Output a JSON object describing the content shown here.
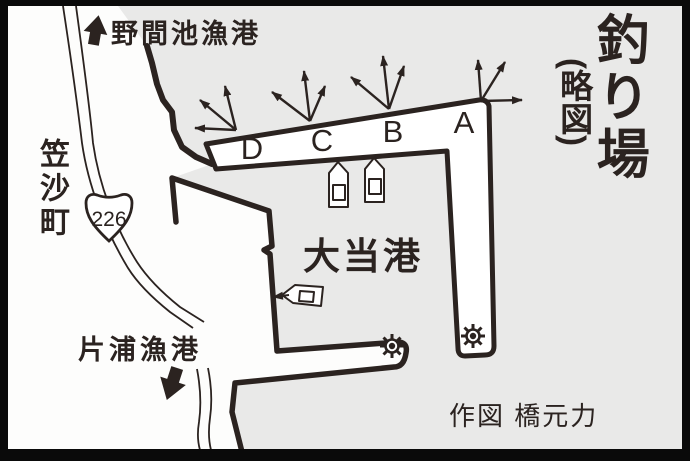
{
  "map": {
    "title_main": "釣り場",
    "title_sub": "(略図)",
    "credit": "作図 橋元力",
    "port_name": "大当港",
    "town_label": "笠沙町",
    "route_number": "226",
    "dest_north": "野間池漁港",
    "dest_south": "片浦漁港",
    "spot_labels": [
      "D",
      "C",
      "B",
      "A"
    ],
    "icons": {
      "north_arrow": "up-arrow-icon",
      "south_arrow": "down-arrow-icon",
      "boats": "boat-icon",
      "lights": "harbor-light-icon",
      "casting_arrows": "fishing-direction-arrows"
    },
    "colors": {
      "sea": "#e9e9e8",
      "land": "#fdfdfc",
      "ink": "#2b2320",
      "frame": "#0a0a0a"
    }
  }
}
